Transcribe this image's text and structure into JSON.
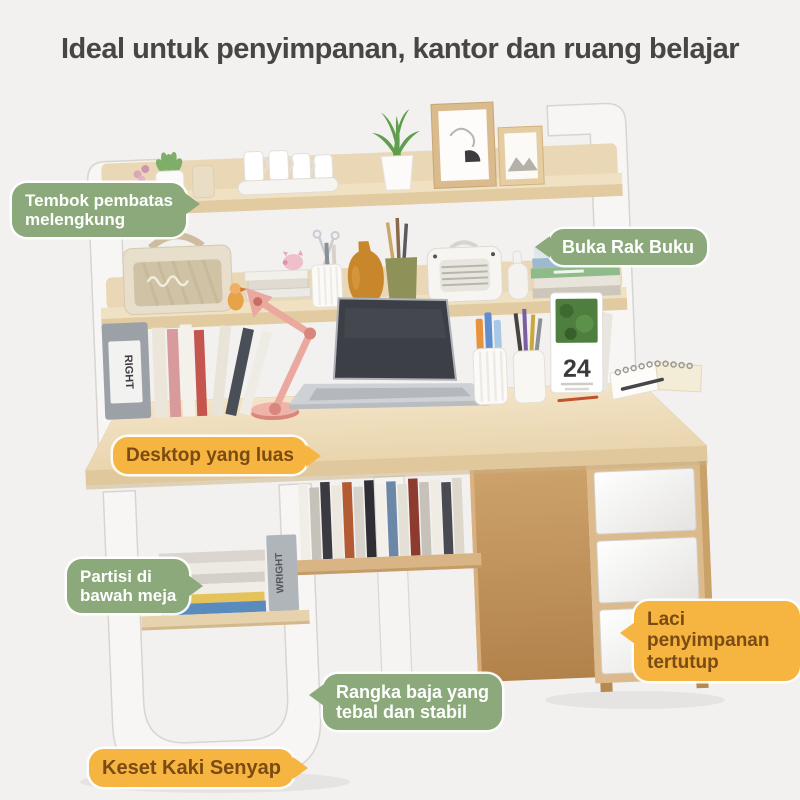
{
  "title": "Ideal untuk penyimpanan, kantor dan ruang belajar",
  "labels": [
    {
      "id": "curved-partition",
      "text": "Tembok pembatas\nmelengkung",
      "style": "green",
      "arrow": "right"
    },
    {
      "id": "open-book-rack",
      "text": "Buka Rak Buku",
      "style": "green",
      "arrow": "left"
    },
    {
      "id": "spacious-desktop",
      "text": "Desktop yang luas",
      "style": "orange",
      "arrow": "right"
    },
    {
      "id": "under-desk-partition",
      "text": "Partisi di\nbawah meja",
      "style": "green",
      "arrow": "right"
    },
    {
      "id": "closed-storage-drawers",
      "text": "Laci penyimpanan\ntertutup",
      "style": "orange",
      "arrow": "left"
    },
    {
      "id": "steel-frame",
      "text": "Rangka baja yang\ntebal dan stabil",
      "style": "green",
      "arrow": "left"
    },
    {
      "id": "silent-foot-pads",
      "text": "Keset Kaki Senyap",
      "style": "orange",
      "arrow": "right"
    }
  ],
  "scene": {
    "calendar_day": "24",
    "bookend_text": "WRIGHT",
    "file_box_text": "RIGHT"
  },
  "colors": {
    "background": "#f2f1ef",
    "title_text": "#474645",
    "green_label": "#8BA97B",
    "orange_label": "#F6B440",
    "orange_label_text": "#7A4B12",
    "wood_light": "#EFE0C2",
    "wood_edge": "#E2CBA0",
    "wood_mid": "#DCBA8B",
    "wood_dark": "#C2945D",
    "frame_white": "#F7F6F4",
    "frame_stroke": "#D8D5D0"
  }
}
